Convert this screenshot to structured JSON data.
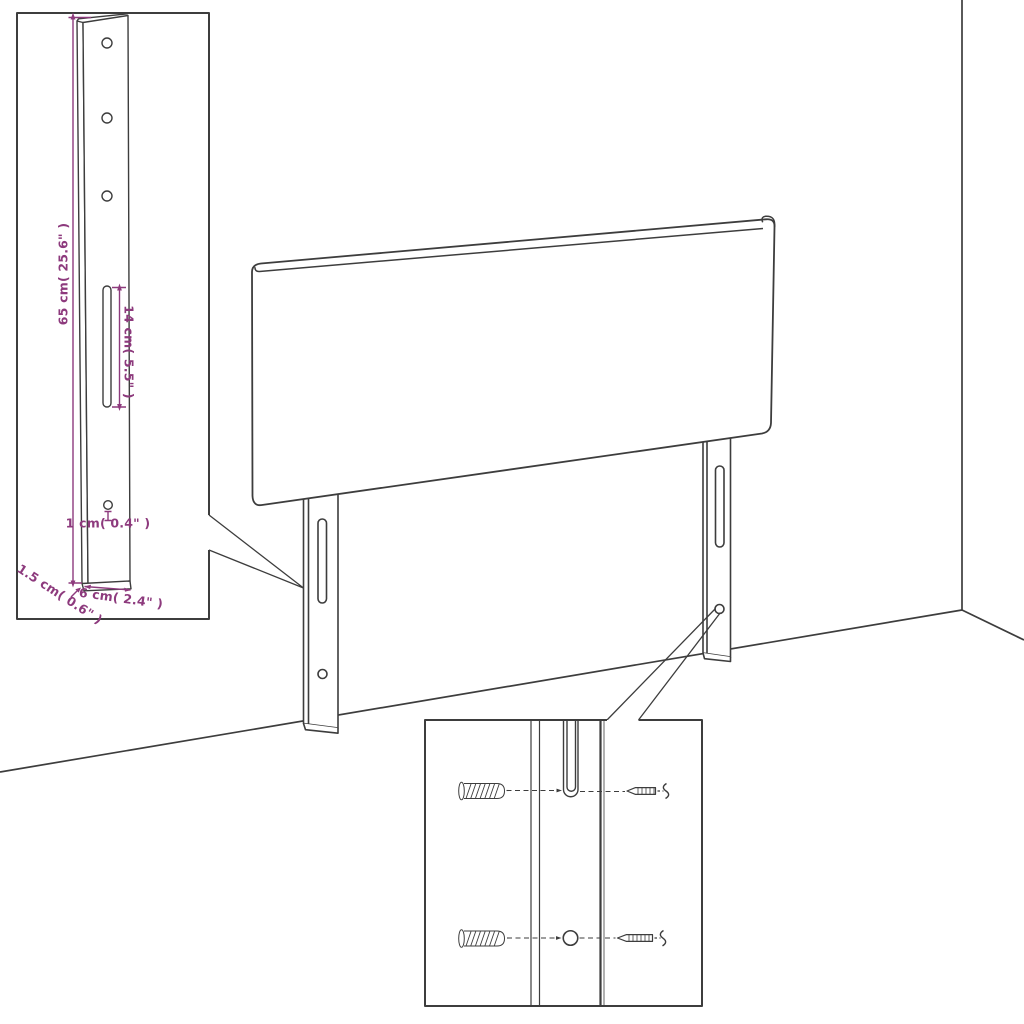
{
  "diagram": {
    "colors": {
      "line": "#3d3d3d",
      "dimension": "#8d3a7d",
      "background": "#ffffff"
    },
    "leg_detail_inset": {
      "labels": {
        "height": "65 cm( 25.6\" )",
        "slot_length": "14 cm( 5.5\" )",
        "hole": "1 cm( 0.4\" )",
        "thickness": "1.5 cm( 0.6\" )",
        "width": "6 cm( 2.4\" )"
      }
    }
  }
}
